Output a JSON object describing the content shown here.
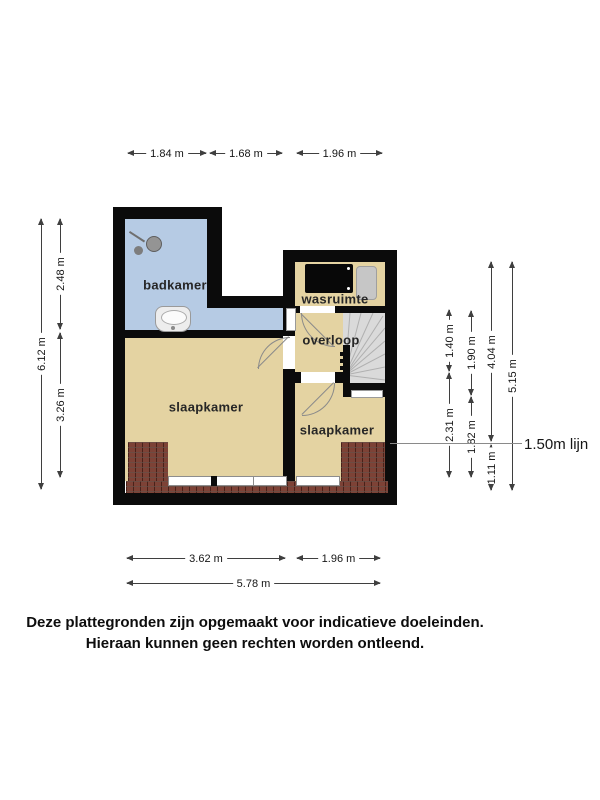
{
  "plan": {
    "rooms": [
      {
        "id": "badkamer",
        "label": "badkamer"
      },
      {
        "id": "wasruimte",
        "label": "wasruimte"
      },
      {
        "id": "overloop",
        "label": "overloop"
      },
      {
        "id": "slaapkamer_left",
        "label": "slaapkamer"
      },
      {
        "id": "slaapkamer_right",
        "label": "slaapkamer"
      }
    ],
    "fixtures": [
      "shower-icon",
      "sink-icon",
      "washing-machine-icon",
      "appliance-icon",
      "stairs",
      "roof-slope-hatch",
      "window"
    ],
    "colors": {
      "wall": "#0b0b0b",
      "bathroom_floor": "#b6cbe4",
      "room_floor": "#e4d3a2",
      "stairs": "#dadada",
      "roof_tiles": "#7d4236",
      "dimension_line": "#3f3f3f"
    }
  },
  "dimensions": {
    "top": [
      "1.84 m",
      "1.68 m",
      "1.96 m"
    ],
    "left": {
      "total": "6.12 m",
      "upper": "2.48 m",
      "lower": "3.26 m"
    },
    "right_col1": [
      "1.40 m",
      "2.31 m"
    ],
    "right_col2": [
      "1.90 m",
      "1.82 m"
    ],
    "right_col3": [
      "4.04 m",
      "1.11 m"
    ],
    "right_col4": "5.15 m",
    "bottom": [
      "3.62 m",
      "1.96 m"
    ],
    "bottom_total": "5.78 m",
    "line_150": "1.50m lijn"
  },
  "footer": {
    "line1": "Deze plattegronden zijn opgemaakt voor indicatieve doeleinden.",
    "line2": "Hieraan kunnen geen rechten worden ontleend."
  }
}
